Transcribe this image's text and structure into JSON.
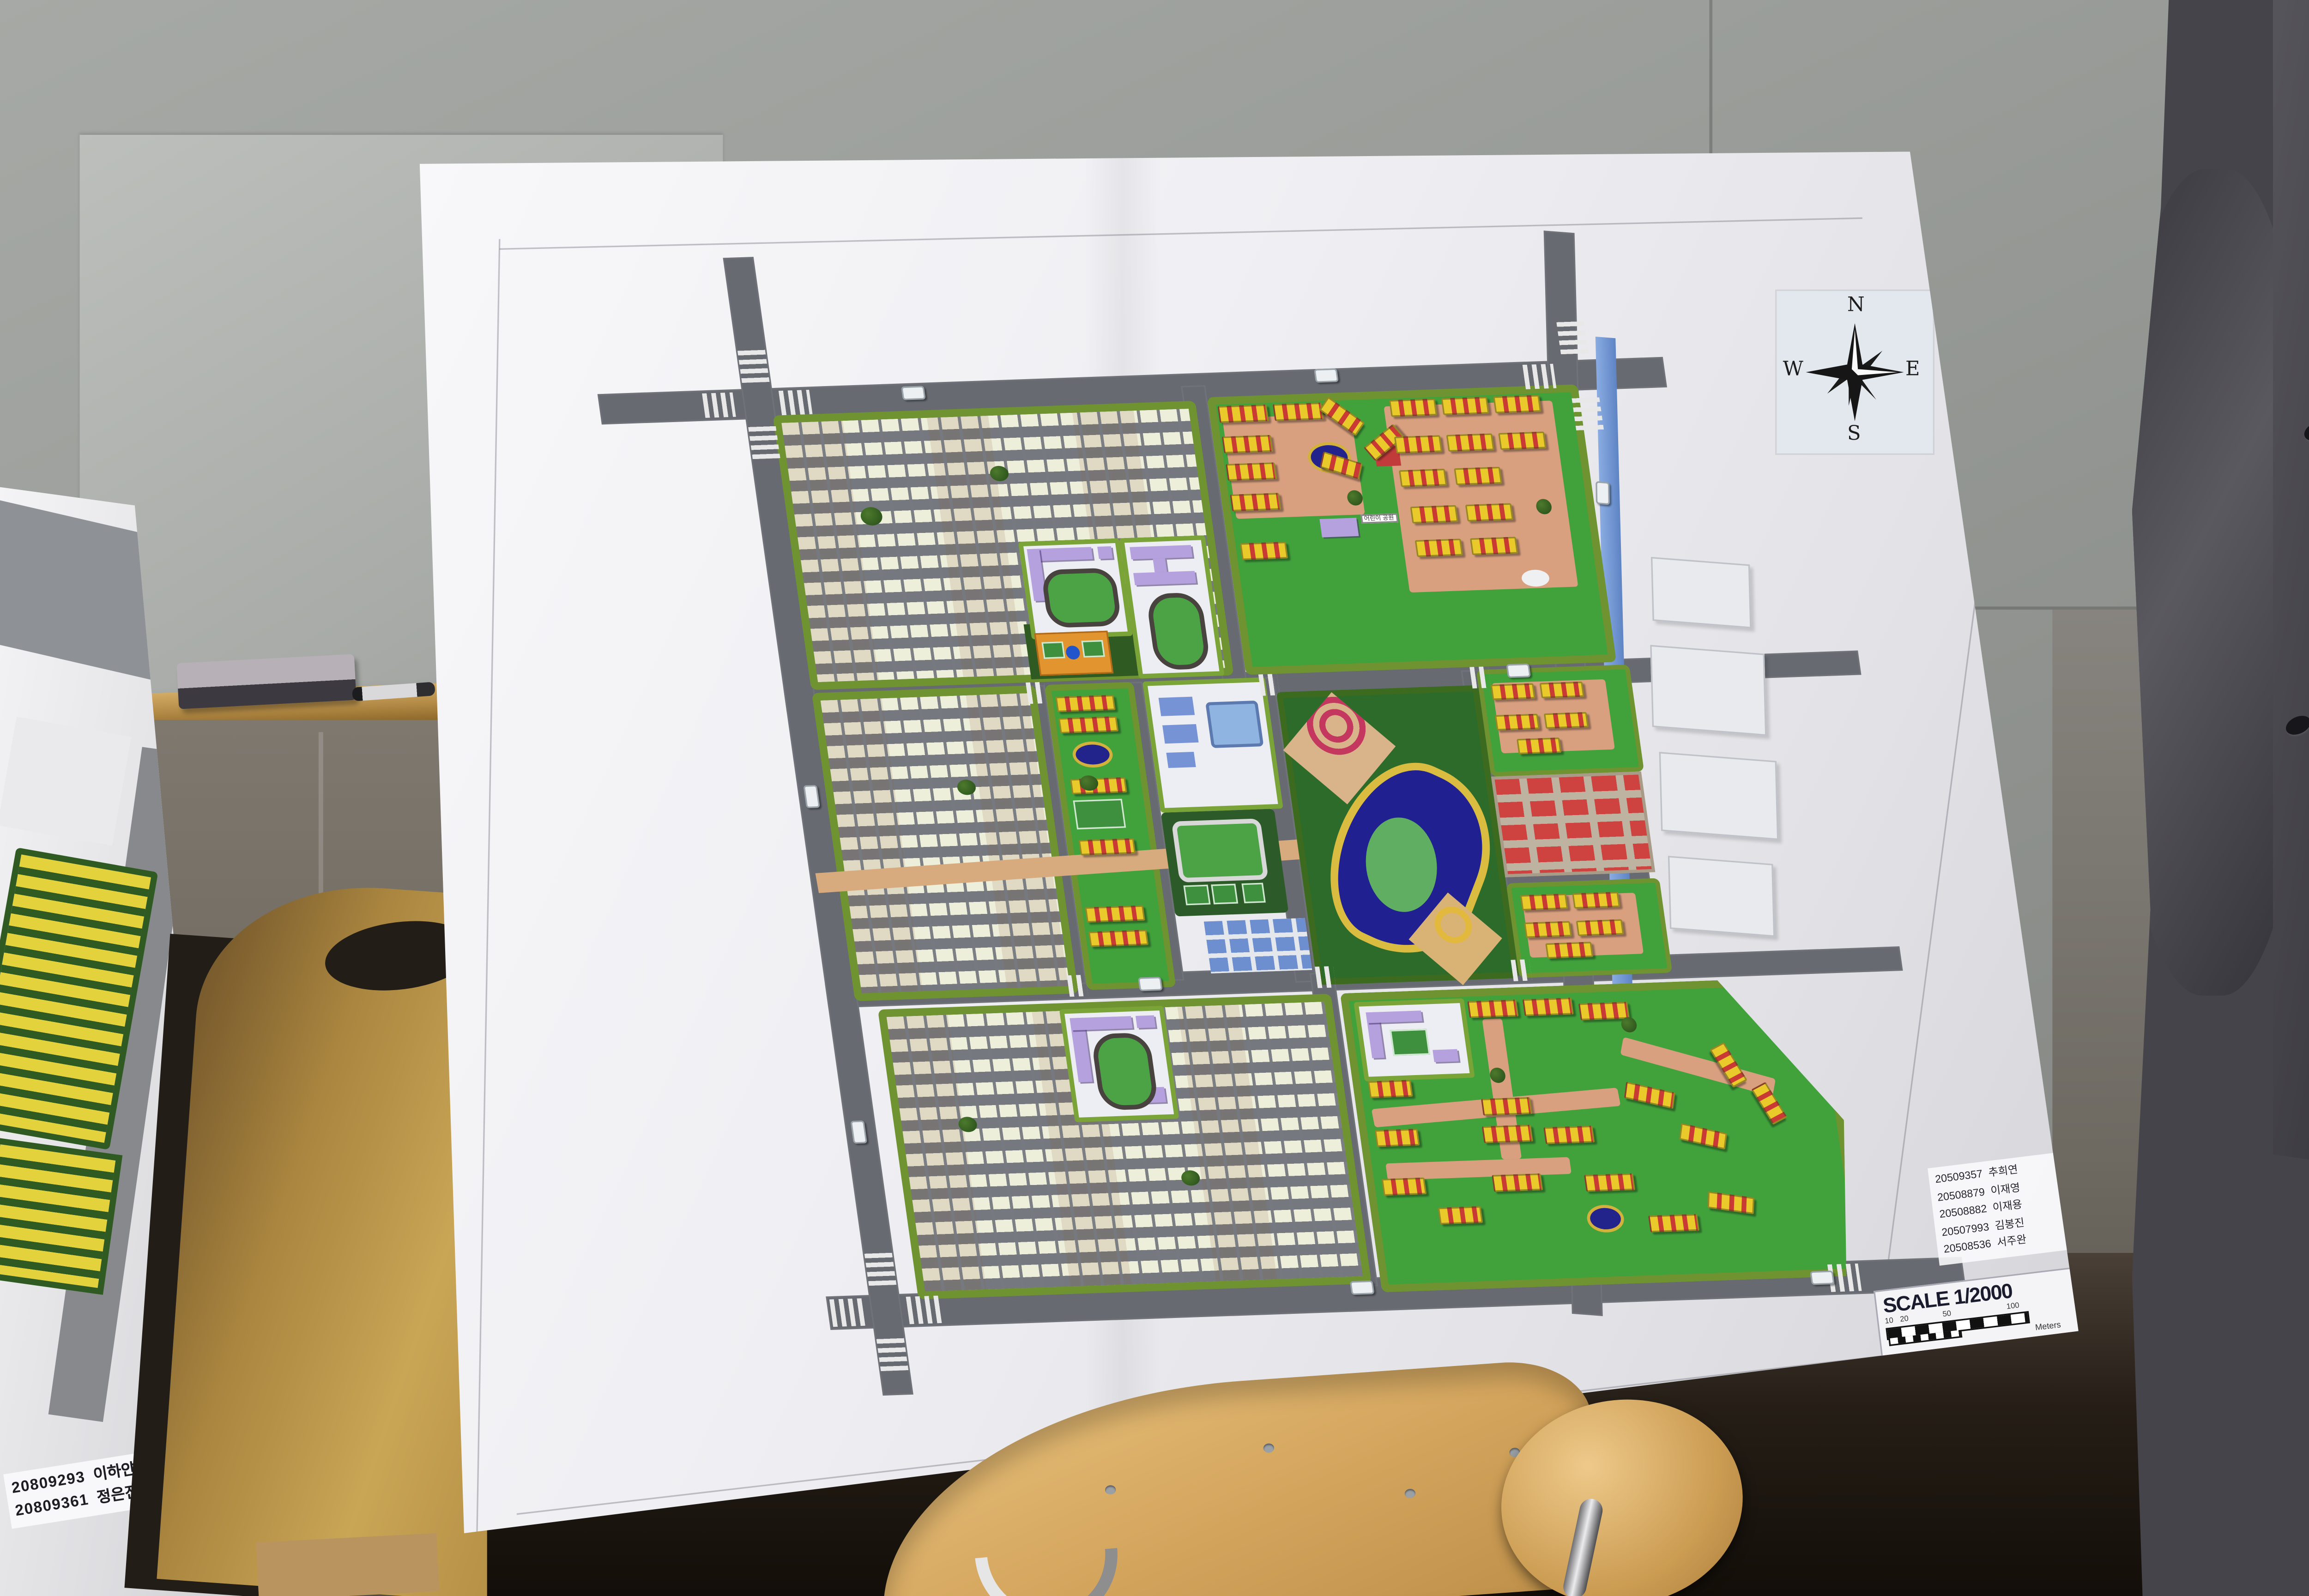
{
  "compass": {
    "n": "N",
    "e": "E",
    "s": "S",
    "w": "W"
  },
  "scale_box": {
    "title": "SCALE 1/2000",
    "ticks": [
      "10",
      "20",
      "50",
      "100"
    ],
    "unit": "Meters"
  },
  "credits": [
    {
      "id": "20509357",
      "name": "추희연"
    },
    {
      "id": "20508879",
      "name": "이재영"
    },
    {
      "id": "20508882",
      "name": "이재용"
    },
    {
      "id": "20507993",
      "name": "김봉진"
    },
    {
      "id": "20508536",
      "name": "서주완"
    }
  ],
  "left_poster": {
    "credits": [
      {
        "id": "20809293",
        "name": "이하얀"
      },
      {
        "id": "20809361",
        "name": "정은진"
      }
    ]
  },
  "model_signs": {
    "children_park": "어린이 공원"
  },
  "colors": {
    "road_gray": "#676b71",
    "hedge_green": "#6e9330",
    "lawn_green": "#41a23c",
    "park_green": "#2d6b2b",
    "housing_cream": "#eeefdb",
    "apartment_yellow": "#e9ca2a",
    "apartment_red": "#c93a35",
    "school_purple": "#b4a1dd",
    "commercial_red": "#ce4340",
    "commercial_blue": "#6d8ecf",
    "pond_navy": "#23238c",
    "pond_rim_yellow": "#d2b13c",
    "river_blue": "#5e84c4",
    "path_salmon": "#d9a07f",
    "promenade_tan": "#d7ab7d"
  }
}
